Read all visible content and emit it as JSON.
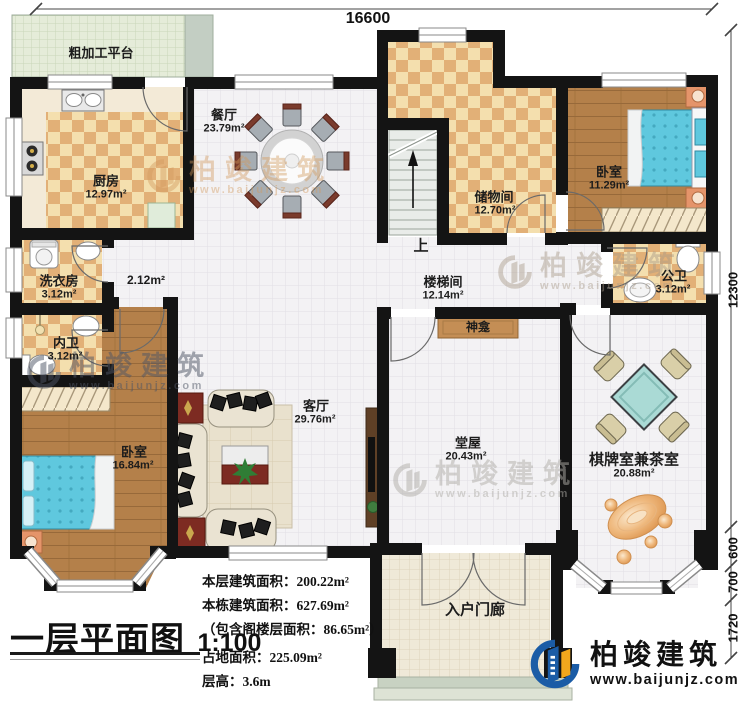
{
  "title": {
    "text": "一层平面图",
    "scale": "1:100"
  },
  "stats": {
    "lines": [
      "本层建筑面积：200.22m²",
      "本栋建筑面积：627.69m²",
      "（包含阁楼层面积：86.65m²）",
      "占地面积：225.09m²",
      "层高：3.6m"
    ]
  },
  "dimensions": {
    "top_width": "16600",
    "right_height": "12300",
    "right_segments": [
      "600",
      "700",
      "1720"
    ]
  },
  "rooms": {
    "platform": {
      "name": "粗加工平台"
    },
    "dining": {
      "name": "餐厅",
      "area": "23.79m²"
    },
    "kitchen": {
      "name": "厨房",
      "area": "12.97m²"
    },
    "laundry": {
      "name": "洗衣房",
      "area": "3.12m²"
    },
    "corridor": {
      "area": "2.12m²"
    },
    "bath_inner": {
      "name": "内卫",
      "area": "3.12m²"
    },
    "bedroom_left": {
      "name": "卧室",
      "area": "16.84m²"
    },
    "living": {
      "name": "客厅",
      "area": "29.76m²"
    },
    "stair_hall": {
      "name": "楼梯间",
      "area": "12.14m²"
    },
    "storage": {
      "name": "储物间",
      "area": "12.70m²"
    },
    "bedroom_right": {
      "name": "卧室",
      "area": "11.29m²"
    },
    "bath_public": {
      "name": "公卫",
      "area": "3.12m²"
    },
    "shrine": {
      "name": "神龛"
    },
    "hall": {
      "name": "堂屋",
      "area": "20.43m²"
    },
    "chess": {
      "name": "棋牌室兼茶室",
      "area": "20.88m²"
    },
    "porch": {
      "name": "入户门廊"
    },
    "stairs_up": {
      "label": "上"
    }
  },
  "logo": {
    "name": "柏竣建筑",
    "website": "www.baijunjz.com"
  },
  "watermark": {
    "name": "柏竣建筑",
    "website": "www.baijunjz.com"
  },
  "colors": {
    "wall": "#141414",
    "logo_blue": "#1b5ca6",
    "logo_orange": "#f2a71d",
    "bed": "#5fc8de",
    "tea_table": "#aadad5",
    "checker_dark": "#e2b077",
    "wood": "#b4804a"
  }
}
